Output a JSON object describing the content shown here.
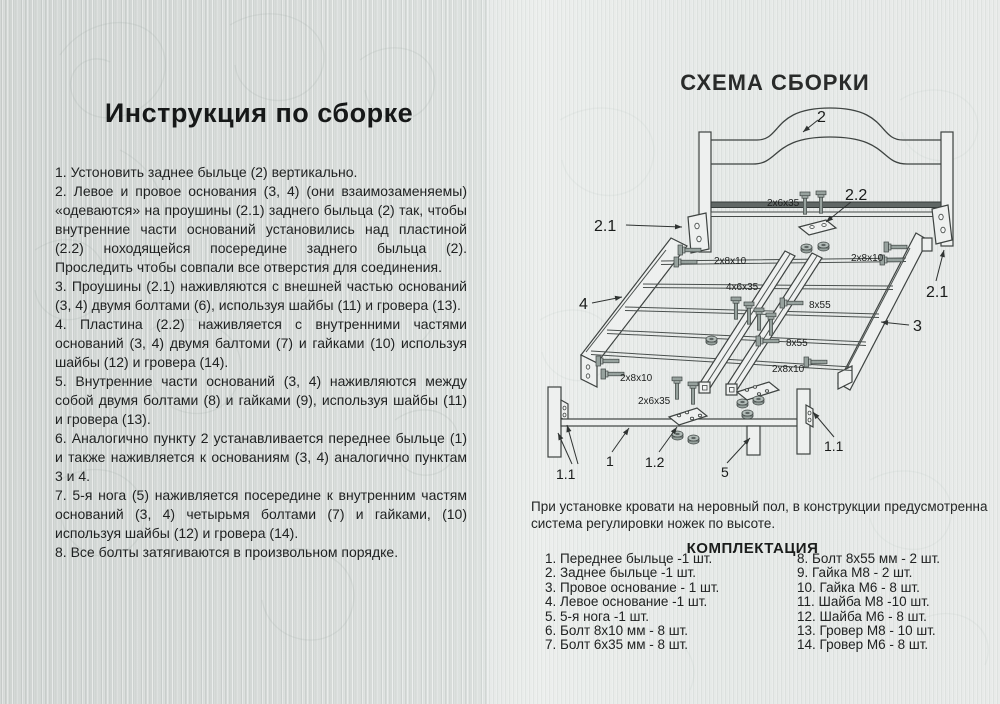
{
  "instruction": {
    "title": "Инструкция по сборке",
    "items": [
      "1.  Устоновить заднее быльце (2) вертикально.",
      "2. Левое и провое основания (3, 4) (они взаимозаменяемы) «одеваются» на проушины (2.1) заднего быльца (2) так, чтобы внутренние части оснований установились над пластиной (2.2) ноходящейся посередине заднего быльца (2). Проследить чтобы совпали все отверстия для соединения.",
      "3. Проушины (2.1) наживляются с внешней частью оснований (3, 4) двумя болтами (6), используя шайбы (11) и гровера (13).",
      "4. Пластина (2.2) наживляется с внутренними частями оснований (3, 4) двумя балтоми (7) и гайками (10) используя шайбы (12) и гровера (14).",
      "5. Внутренние части оснований (3, 4) наживляются между собой двумя болтами (8) и гайками (9), используя шайбы (11) и гровера (13).",
      "6. Аналогично пункту 2 устанавливается переднее быльце (1) и также наживляется к основаниям (3, 4) аналогично пунктам 3 и 4.",
      "7. 5-я нога (5) наживляется посередине к внутренним частям оснований (3, 4) четырьмя болтами (7) и гайками, (10) используя шайбы (12) и гровера (14).",
      "8. Все болты затягиваются в произвольном порядке."
    ]
  },
  "schema": {
    "title": "СХЕМА СБОРКИ",
    "note": "При установке кровати на неровный пол, в конструкции предусмотренна система регулировки ножек по высоте.",
    "labels": {
      "p1": "1",
      "p1_1": "1.1",
      "p1_2": "1.2",
      "p2": "2",
      "p2_1": "2.1",
      "p2_2": "2.2",
      "p3": "3",
      "p4": "4",
      "p5": "5"
    },
    "hardware": {
      "b2x6x35": "2x6x35",
      "b2x8x10": "2x8x10",
      "b4x6x35": "4x6x35",
      "b8x55": "8x55"
    }
  },
  "kit": {
    "title": "КОМПЛЕКТАЦИЯ",
    "col_left": [
      "1. Переднее быльце -1 шт.",
      "2. Заднее быльце -1 шт.",
      "3. Провое основание - 1 шт.",
      "4. Левое основание -1 шт.",
      "5. 5-я нога -1 шт.",
      "6. Болт 8x10 мм - 8 шт.",
      "7. Болт 6x35 мм - 8 шт."
    ],
    "col_right": [
      "8. Болт 8x55 мм - 2 шт.",
      "9. Гайка М8 - 2 шт.",
      "10. Гайка М6 - 8 шт.",
      "11. Шайба М8 -10 шт.",
      "12. Шайба М6 - 8 шт.",
      "13. Гровер М8 - 10 шт.",
      "14. Гровер М6 - 8 шт."
    ]
  },
  "colors": {
    "paper_left": "#dce0de",
    "paper_right": "#e6e9e7",
    "line": "#3e4341",
    "metal": "#97a29e",
    "text": "#1f2121"
  }
}
